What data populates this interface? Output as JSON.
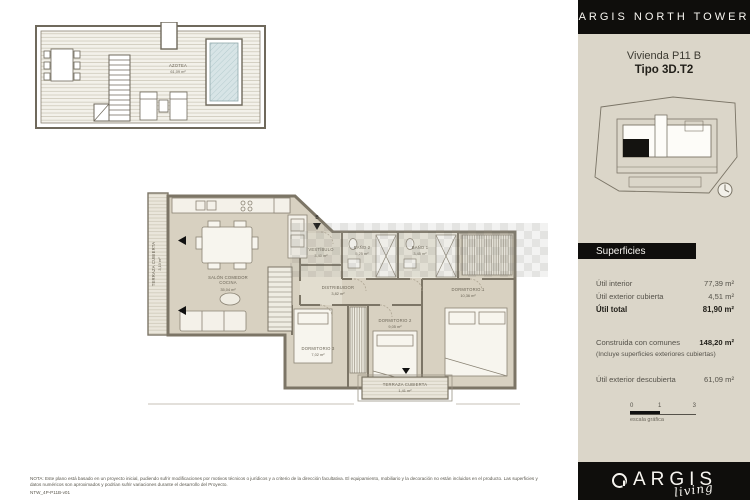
{
  "sidebar": {
    "header_title": "ARGIS NORTH TOWER",
    "unit_name": "Vivienda P11 B",
    "unit_type": "Tipo 3D.T2",
    "superficies_title": "Superficies",
    "rows": [
      {
        "label": "Útil interior",
        "value": "77,39 m²"
      },
      {
        "label": "Útil exterior cubierta",
        "value": "4,51 m²"
      },
      {
        "label": "Útil total",
        "value": "81,90 m²"
      }
    ],
    "construida": {
      "label": "Construida con comunes",
      "value": "148,20 m²",
      "note": "(Incluye superficies exteriores cubiertas)"
    },
    "descubierta": {
      "label": "Útil exterior descubierta",
      "value": "61,09 m²"
    },
    "scalebar": {
      "t0": "0",
      "t1": "1",
      "t2": "3",
      "caption": "escala gráfica"
    },
    "footer_brand": "ARGIS",
    "footer_script": "living"
  },
  "roofplan": {
    "label": "AZOTEA",
    "area": "61,09 m²"
  },
  "floorplan": {
    "entry_label": "B",
    "rooms": [
      {
        "label": "TERRAZA CUBIERTA",
        "area": "3,10 m²"
      },
      {
        "label": "SALÓN COMEDOR",
        "label2": "COCINA",
        "area": "35,04 m²"
      },
      {
        "label": "VESTÍBULO",
        "area": "3,40 m²"
      },
      {
        "label": "DISTRIBUIDOR",
        "area": "3,82 m²"
      },
      {
        "label": "BAÑO 2",
        "area": "5,25 m²"
      },
      {
        "label": "BAÑO 1",
        "area": "3,45 m²"
      },
      {
        "label": "DORMITORIO 1",
        "area": "10,36 m²"
      },
      {
        "label": "DORMITORIO 2",
        "area": "9,05 m²"
      },
      {
        "label": "DORMITORIO 3",
        "area": "7,02 m²"
      },
      {
        "label": "TERRAZA CUBIERTA",
        "area": "1,41 m²"
      }
    ]
  },
  "note": {
    "line1": "NOTA: Este plano está basado en un proyecto inicial, pudiendo sufrir modificaciones por motivos técnicos o jurídicos y a criterio de la dirección facultativa. El equipamiento, mobiliario y la decoración no están incluidos en el producto. Las superficies y datos",
    "line2": "numéricos son aproximados y podrían sufrir variaciones durante el desarrollo del Proyecto.",
    "code": "NTW_4P-P11B-v01"
  },
  "colors": {
    "brand_black": "#0f0e0c",
    "panel_beige": "#dbd6c9",
    "floor": "#d8d1c1",
    "terrace": "#e7e3d8",
    "wall": "#7c7566",
    "pool": "#d7e4e6"
  }
}
